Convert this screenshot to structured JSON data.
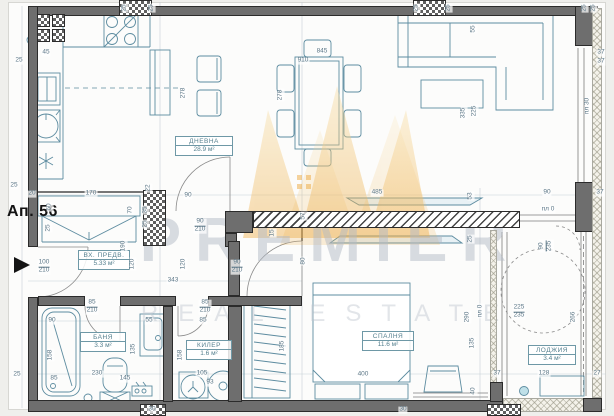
{
  "title": "Ап. 56",
  "watermark": {
    "line1": "PREMIER",
    "line2": "REAL ESTATE"
  },
  "colors": {
    "wall": "#6e6e6e",
    "furniture_stroke": "#5d8ca0",
    "dimension_text": "#5b7686",
    "label_text": "#56808f",
    "watermark_gold": "#f0bf6a",
    "ink": "#141414"
  },
  "rooms": [
    {
      "id": "living",
      "name": "ДНЕВНА",
      "area": "28.9 м²",
      "x": 175,
      "y": 136,
      "w": 58
    },
    {
      "id": "entry",
      "name": "ВХ. ПРЕДВ.",
      "area": "5.33 м²",
      "x": 78,
      "y": 250,
      "w": 52
    },
    {
      "id": "bathroom",
      "name": "БАНЯ",
      "area": "3.3 м²",
      "x": 80,
      "y": 332,
      "w": 46
    },
    {
      "id": "closet",
      "name": "КИЛЕР",
      "area": "1.6 м²",
      "x": 186,
      "y": 340,
      "w": 46
    },
    {
      "id": "bedroom",
      "name": "СПАЛНЯ",
      "area": "11.6 м²",
      "x": 362,
      "y": 331,
      "w": 52
    },
    {
      "id": "loggia",
      "name": "ЛОДЖИЯ",
      "area": "3.4 м²",
      "x": 528,
      "y": 345,
      "w": 48
    }
  ],
  "dimensions": [
    {
      "t": "25",
      "x": 125,
      "y": 8,
      "o": "v"
    },
    {
      "t": "25",
      "x": 152,
      "y": 8,
      "o": "v"
    },
    {
      "t": "25",
      "x": 417,
      "y": 8,
      "o": "v"
    },
    {
      "t": "25",
      "x": 449,
      "y": 8,
      "o": "v"
    },
    {
      "t": "25",
      "x": 585,
      "y": 8,
      "o": "v"
    },
    {
      "t": "25",
      "x": 594,
      "y": 8,
      "o": "v"
    },
    {
      "t": "25",
      "x": 19,
      "y": 61,
      "o": "h"
    },
    {
      "t": "45",
      "x": 46,
      "y": 53,
      "o": "h"
    },
    {
      "t": "278",
      "x": 184,
      "y": 93,
      "o": "v"
    },
    {
      "t": "278",
      "x": 281,
      "y": 95,
      "o": "v"
    },
    {
      "t": "845",
      "x": 322,
      "y": 52,
      "o": "h"
    },
    {
      "t": "910",
      "x": 303,
      "y": 61,
      "o": "h"
    },
    {
      "t": "55",
      "x": 474,
      "y": 29,
      "o": "v"
    },
    {
      "t": "335",
      "x": 464,
      "y": 113,
      "o": "v"
    },
    {
      "t": "225",
      "x": 475,
      "y": 111,
      "o": "v"
    },
    {
      "t": "37",
      "x": 601,
      "y": 53,
      "o": "h"
    },
    {
      "t": "37",
      "x": 601,
      "y": 62,
      "o": "h"
    },
    {
      "t": "пл 30",
      "x": 588,
      "y": 106,
      "o": "v"
    },
    {
      "t": "25",
      "x": 14,
      "y": 186,
      "o": "h"
    },
    {
      "t": "20",
      "x": 32,
      "y": 194,
      "o": "h"
    },
    {
      "t": "170",
      "x": 91,
      "y": 194,
      "o": "h"
    },
    {
      "t": "60",
      "x": 50,
      "y": 207,
      "o": "v"
    },
    {
      "t": "25",
      "x": 49,
      "y": 228,
      "o": "v"
    },
    {
      "t": "90",
      "x": 188,
      "y": 196,
      "o": "h"
    },
    {
      "t": "22",
      "x": 149,
      "y": 188,
      "o": "v"
    },
    {
      "t": "35",
      "x": 146,
      "y": 210,
      "o": "v"
    },
    {
      "t": "25",
      "x": 146,
      "y": 224,
      "o": "v"
    },
    {
      "t": "70",
      "x": 131,
      "y": 210,
      "o": "v"
    },
    {
      "t": "190",
      "x": 124,
      "y": 246,
      "o": "v"
    },
    {
      "t": "120",
      "x": 133,
      "y": 264,
      "o": "v"
    },
    {
      "t": "120",
      "x": 184,
      "y": 264,
      "o": "v"
    },
    {
      "t": "90/210",
      "x": 200,
      "y": 226,
      "o": "f"
    },
    {
      "t": "90/210",
      "x": 237,
      "y": 267,
      "o": "f"
    },
    {
      "t": "57",
      "x": 304,
      "y": 216,
      "o": "v"
    },
    {
      "t": "15",
      "x": 273,
      "y": 233,
      "o": "v"
    },
    {
      "t": "80",
      "x": 304,
      "y": 261,
      "o": "v"
    },
    {
      "t": "485",
      "x": 377,
      "y": 193,
      "o": "h"
    },
    {
      "t": "53",
      "x": 471,
      "y": 196,
      "o": "v"
    },
    {
      "t": "25",
      "x": 471,
      "y": 239,
      "o": "v"
    },
    {
      "t": "90",
      "x": 547,
      "y": 193,
      "o": "h"
    },
    {
      "t": "37",
      "x": 600,
      "y": 193,
      "o": "h"
    },
    {
      "t": "пл 0",
      "x": 548,
      "y": 210,
      "o": "h"
    },
    {
      "t": "90/235",
      "x": 546,
      "y": 246,
      "o": "fv"
    },
    {
      "t": "100/210",
      "x": 44,
      "y": 267,
      "o": "f"
    },
    {
      "t": "343",
      "x": 173,
      "y": 281,
      "o": "h"
    },
    {
      "t": "85/210",
      "x": 92,
      "y": 307,
      "o": "f"
    },
    {
      "t": "85/210",
      "x": 205,
      "y": 307,
      "o": "f"
    },
    {
      "t": "90",
      "x": 52,
      "y": 321,
      "o": "h"
    },
    {
      "t": "55",
      "x": 149,
      "y": 321,
      "o": "h"
    },
    {
      "t": "85",
      "x": 54,
      "y": 379,
      "o": "h"
    },
    {
      "t": "230",
      "x": 97,
      "y": 374,
      "o": "h"
    },
    {
      "t": "145",
      "x": 125,
      "y": 379,
      "o": "h"
    },
    {
      "t": "135",
      "x": 134,
      "y": 349,
      "o": "v"
    },
    {
      "t": "158",
      "x": 51,
      "y": 355,
      "o": "v"
    },
    {
      "t": "158",
      "x": 181,
      "y": 355,
      "o": "v"
    },
    {
      "t": "85",
      "x": 203,
      "y": 321,
      "o": "h"
    },
    {
      "t": "105",
      "x": 202,
      "y": 374,
      "o": "h"
    },
    {
      "t": "93",
      "x": 210,
      "y": 383,
      "o": "h"
    },
    {
      "t": "185",
      "x": 283,
      "y": 346,
      "o": "v"
    },
    {
      "t": "400",
      "x": 363,
      "y": 375,
      "o": "h"
    },
    {
      "t": "290",
      "x": 468,
      "y": 317,
      "o": "v"
    },
    {
      "t": "135",
      "x": 473,
      "y": 343,
      "o": "v"
    },
    {
      "t": "40",
      "x": 474,
      "y": 391,
      "o": "v"
    },
    {
      "t": "пл 0",
      "x": 481,
      "y": 311,
      "o": "v"
    },
    {
      "t": "225/235",
      "x": 519,
      "y": 312,
      "o": "f"
    },
    {
      "t": "266",
      "x": 574,
      "y": 317,
      "o": "v"
    },
    {
      "t": "128",
      "x": 544,
      "y": 374,
      "o": "h"
    },
    {
      "t": "37",
      "x": 497,
      "y": 374,
      "o": "h"
    },
    {
      "t": "27",
      "x": 597,
      "y": 374,
      "o": "h"
    },
    {
      "t": "25",
      "x": 17,
      "y": 375,
      "o": "h"
    },
    {
      "t": "30",
      "x": 152,
      "y": 410,
      "o": "h"
    },
    {
      "t": "30",
      "x": 403,
      "y": 410,
      "o": "h"
    }
  ]
}
